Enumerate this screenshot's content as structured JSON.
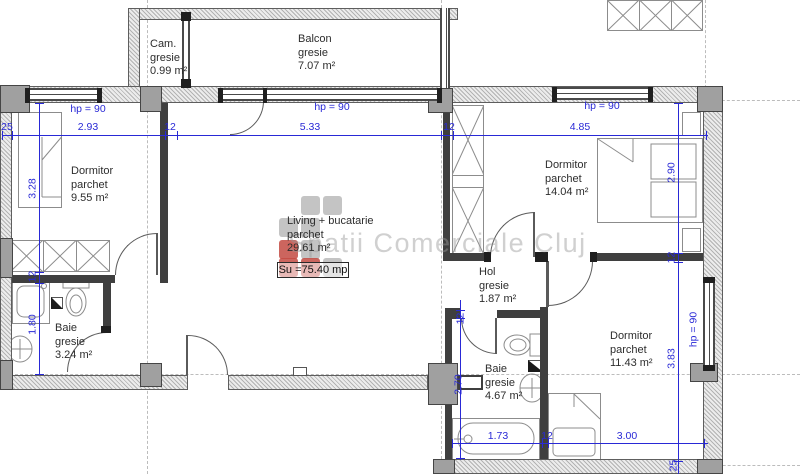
{
  "watermark": {
    "text": "Spatii Comerciale Cluj"
  },
  "summary_box": {
    "text": "Su =75.40 mp"
  },
  "hp_label": "hp = 90",
  "rooms": {
    "cam": {
      "name": "Cam.",
      "finish": "gresie",
      "area": "0.99 m²"
    },
    "balcon": {
      "name": "Balcon",
      "finish": "gresie",
      "area": "7.07 m²"
    },
    "dormitor_left": {
      "name": "Dormitor",
      "finish": "parchet",
      "area": "9.55 m²"
    },
    "living": {
      "name": "Living + bucatarie",
      "finish": "parchet",
      "area": "29.61 m²"
    },
    "dormitor_top_right": {
      "name": "Dormitor",
      "finish": "parchet",
      "area": "14.04 m²"
    },
    "hol": {
      "name": "Hol",
      "finish": "gresie",
      "area": "1.87 m²"
    },
    "baie_left": {
      "name": "Baie",
      "finish": "gresie",
      "area": "3.24 m²"
    },
    "baie_mid": {
      "name": "Baie",
      "finish": "gresie",
      "area": "4.67 m²"
    },
    "dormitor_bot_right": {
      "name": "Dormitor",
      "finish": "parchet",
      "area": "11.43 m²"
    }
  },
  "dims": {
    "top": {
      "wall_left": "25",
      "bedroom": "2.93",
      "wall_mid": "12",
      "living": "5.33",
      "wall_mid2": "12",
      "bedroom_right": "4.85"
    },
    "left": {
      "bedroom": "3.28",
      "wall": "12",
      "bath": "1.80"
    },
    "right": {
      "bedroom_top": "2.90",
      "wall": "12",
      "bedroom_bottom": "3.83",
      "wall_bottom": "25"
    },
    "bath": {
      "wall": "12",
      "height": "2.70"
    },
    "bottom": {
      "bath": "1.73",
      "wall": "12",
      "bedroom": "3.00"
    }
  },
  "colors": {
    "dimension_blue": "#2929d6",
    "wall_dark": "#3f3f3f",
    "column_gray": "#a0a0a0",
    "watermark_red": "#c34a42",
    "watermark_gray": "#ababab"
  }
}
